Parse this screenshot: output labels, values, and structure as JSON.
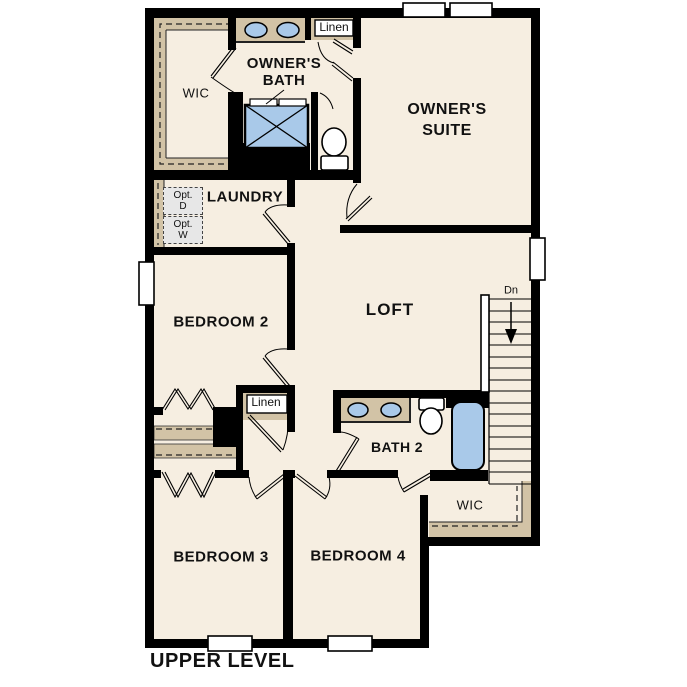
{
  "floor_plan": {
    "title": "UPPER LEVEL",
    "labels": {
      "owners_wic": "WIC",
      "owners_bath": [
        "OWNER'S",
        "BATH"
      ],
      "linen_upper": "Linen",
      "owners_suite": [
        "OWNER'S",
        "SUITE"
      ],
      "laundry": "LAUNDRY",
      "opt_dryer": [
        "Opt.",
        "D"
      ],
      "opt_washer": [
        "Opt.",
        "W"
      ],
      "bedroom2": "BEDROOM 2",
      "loft": "LOFT",
      "stairs_down": "Dn",
      "linen_lower": "Linen",
      "bath2": "BATH 2",
      "bedroom4_wic": "WIC",
      "bedroom3": "BEDROOM 3",
      "bedroom4": "BEDROOM 4"
    },
    "colors": {
      "background": "#ffffff",
      "floor": "#f6eee1",
      "wall": "#000000",
      "casework_tan": "#d2c3a6",
      "fixture_blue": "#a9c9e9",
      "optional_appliance_gray": "#e7e7e7",
      "text": "#111111"
    }
  }
}
